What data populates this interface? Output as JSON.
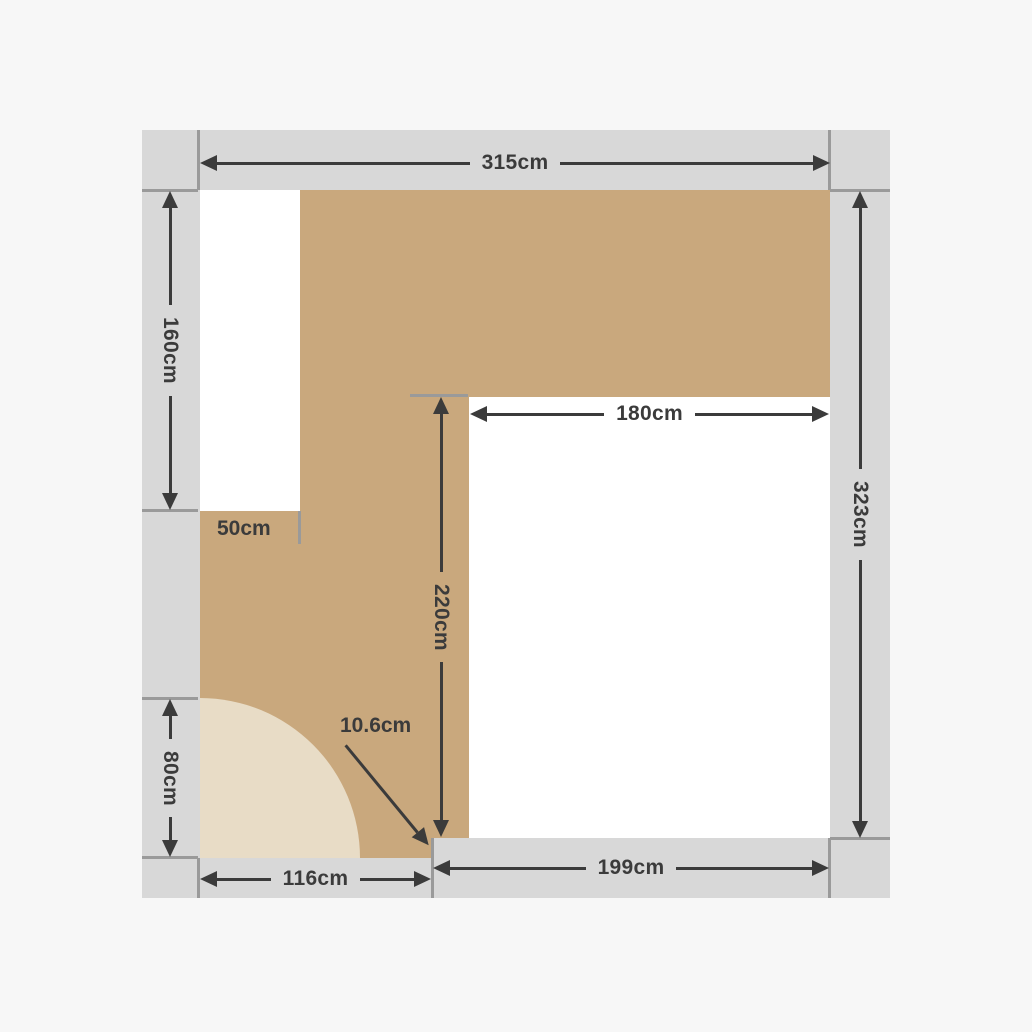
{
  "colors": {
    "bg": "#f7f7f7",
    "wall": "#d8d8d8",
    "joint": "#9a9a9a",
    "tan": "#c9a87d",
    "swing": "#e8dcc6",
    "room": "#ffffff",
    "dim": "#3b3b3b"
  },
  "dims": {
    "top_width": "315cm",
    "left_upper": "160cm",
    "right_height": "323cm",
    "inner_width": "180cm",
    "inner_height": "220cm",
    "left_lower": "80cm",
    "bottom_left": "116cm",
    "bottom_right": "199cm",
    "step": "50cm",
    "offset": "10.6cm"
  }
}
